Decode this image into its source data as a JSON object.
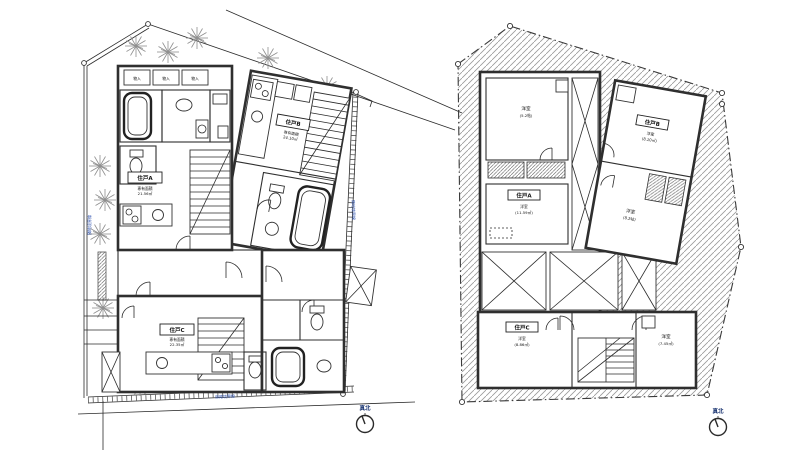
{
  "colors": {
    "line": "#2b2b2b",
    "wall_poche": "#2f2f2f",
    "hatch": "#9a9a9a",
    "tree": "#8f8f8f",
    "dimension_text": "#2a4fae",
    "label_text": "#111111",
    "background": "#ffffff"
  },
  "left_plan": {
    "north_label": "真北",
    "storage_label": "物入",
    "boundary": {
      "top": "道路境界線",
      "left": "隣地境界線",
      "right": "隣地境界線",
      "bottom": "道路境界線"
    },
    "units": {
      "a": {
        "label": "住戸A",
        "sub1": "専有面積",
        "sub2": "21.56㎡"
      },
      "b": {
        "label": "住戸B",
        "sub1": "専有面積",
        "sub2": "24.10㎡"
      },
      "c": {
        "label": "住戸C",
        "sub1": "専有面積",
        "sub2": "22.35㎡"
      }
    }
  },
  "right_plan": {
    "north_label": "真北",
    "rooms": {
      "nw": {
        "name": "洋室",
        "area": "(5.2帖)"
      },
      "a": {
        "label": "住戸A",
        "name": "洋室",
        "area": "(11.59㎡)"
      },
      "b": {
        "label": "住戸B",
        "name": "洋室",
        "area": "(8.10㎡)"
      },
      "e": {
        "name": "洋室",
        "area": "(8.2帖)"
      },
      "c": {
        "label": "住戸C",
        "name": "洋室",
        "area": "(8.86㎡)"
      },
      "se": {
        "name": "洋室",
        "area": "(7.45㎡)"
      }
    }
  }
}
